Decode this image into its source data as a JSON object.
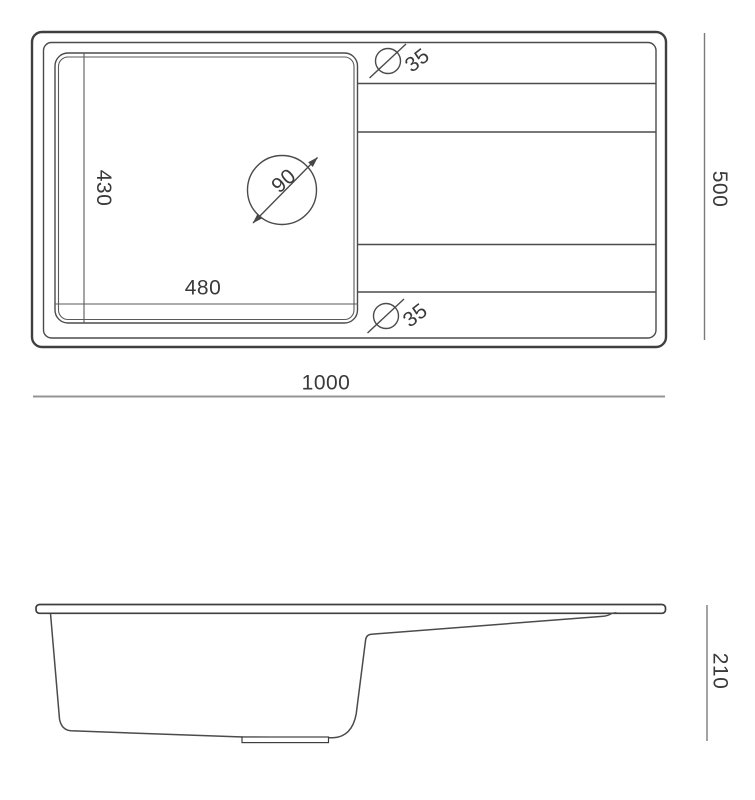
{
  "top_view": {
    "length_label": "1000",
    "width_label": "500",
    "bowl_width_label": "480",
    "bowl_depth_label": "430",
    "faucet_hole_diameter_label": "90",
    "drain_top_diameter_label": "35",
    "drain_bottom_diameter_label": "35"
  },
  "side_view": {
    "height_label": "210"
  }
}
